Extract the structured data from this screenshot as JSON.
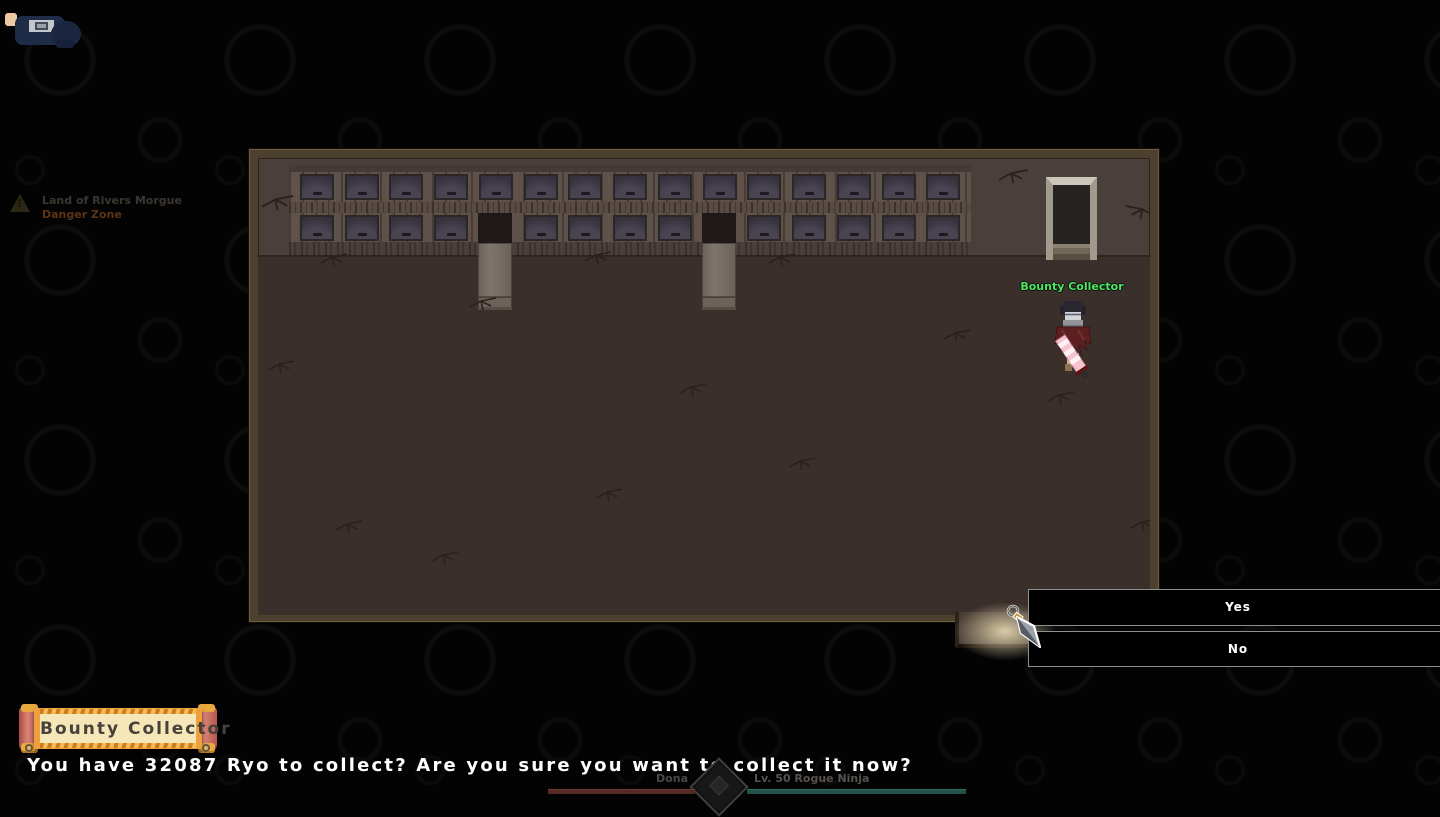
{
  "zone": {
    "name": "Land of Rivers Morgue",
    "status": "Danger Zone"
  },
  "npc": {
    "name": "Bounty Collector"
  },
  "choice_menu": {
    "options": [
      "Yes",
      "No"
    ]
  },
  "dialogue": {
    "title": "Bounty Collector",
    "text": "You have 32087 Ryo to collect? Are you sure you want to collect it now?"
  },
  "player_hud": {
    "name": "Dona",
    "info": "Lv. 50 Rogue Ninja"
  },
  "colors": {
    "npc_name": "#50e466",
    "zone_status": "#5c3415",
    "scroll_border": "#efa03c",
    "scroll_paper": "#f6e7b8",
    "hp_bar": "#542a25",
    "chakra_bar": "#24524a",
    "exit_light": "#f4e5bc"
  }
}
